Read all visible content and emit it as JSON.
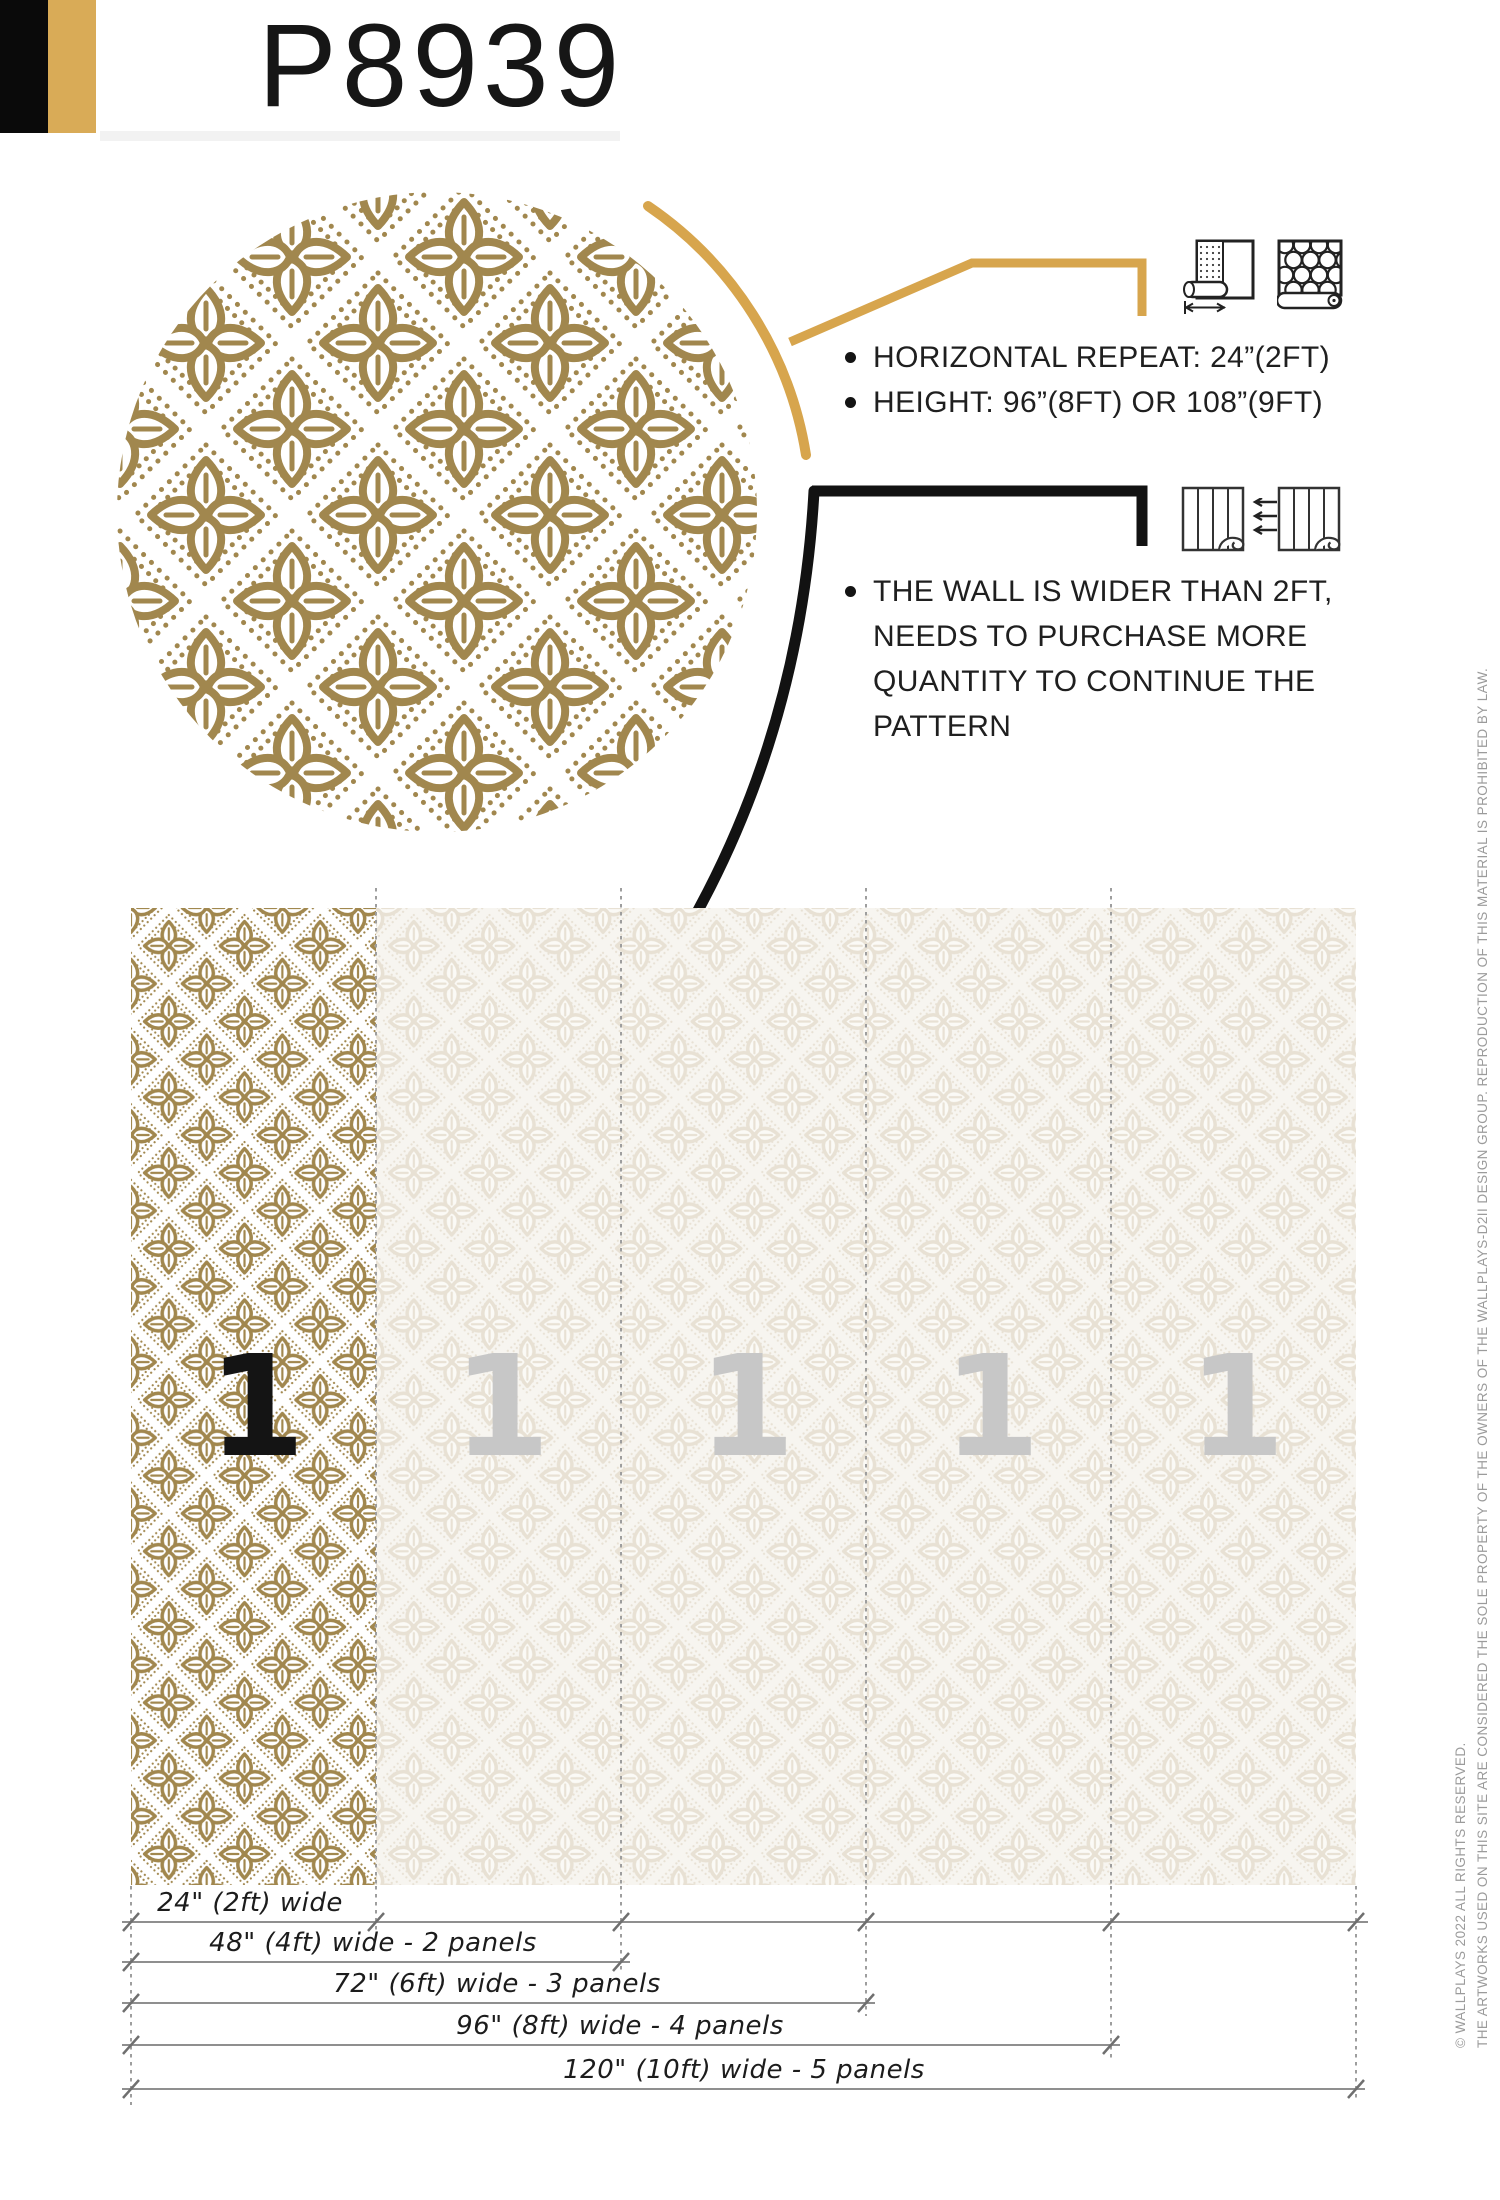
{
  "page": {
    "title": "P8939"
  },
  "brand": {
    "corner_black": "#0a0a0a",
    "corner_gold": "#d9ab57"
  },
  "callout_repeat": {
    "accent_color": "#d7a54d",
    "icons": [
      "roll-width-measure-icon",
      "patterned-roll-icon"
    ],
    "items": [
      "HORIZONTAL REPEAT: 24”(2FT)",
      "HEIGHT: 96”(8FT) OR 108”(9FT)"
    ]
  },
  "callout_panels": {
    "accent_color": "#111111",
    "icons": [
      "wallpaper-panel-icon",
      "left-arrows-icon",
      "wallpaper-panel-icon"
    ],
    "lines": [
      "THE WALL IS WIDER THAN 2FT,",
      "NEEDS TO PURCHASE MORE",
      "QUANTITY TO CONTINUE THE",
      "PATTERN"
    ]
  },
  "diagram": {
    "panel_numbers": [
      "1",
      "1",
      "1",
      "1",
      "1"
    ],
    "dimensions": [
      {
        "label": "24\" (2ft) wide"
      },
      {
        "label": "48\" (4ft) wide - 2 panels"
      },
      {
        "label": "72\" (6ft) wide - 3 panels"
      },
      {
        "label": "96\" (8ft) wide - 4 panels"
      },
      {
        "label": "120\" (10ft) wide - 5 panels"
      }
    ],
    "pattern_colors": {
      "gold": "#a1874e",
      "background": "#ffffff",
      "faded": "#e8e1d4",
      "faded_background": "#f7f5f0"
    }
  },
  "copyright": {
    "line1": "© WALLPLAYS 2022 ALL RIGHTS RESERVED.",
    "line2": "THE ARTWORKS USED ON THIS SITE ARE CONSIDERED THE SOLE PROPERTY OF THE OWNERS OF THE WALLPLAYS-D2II DESIGN GROUP. REPRODUCTION OF THIS MATERIAL IS PROHIBITED BY LAW."
  }
}
